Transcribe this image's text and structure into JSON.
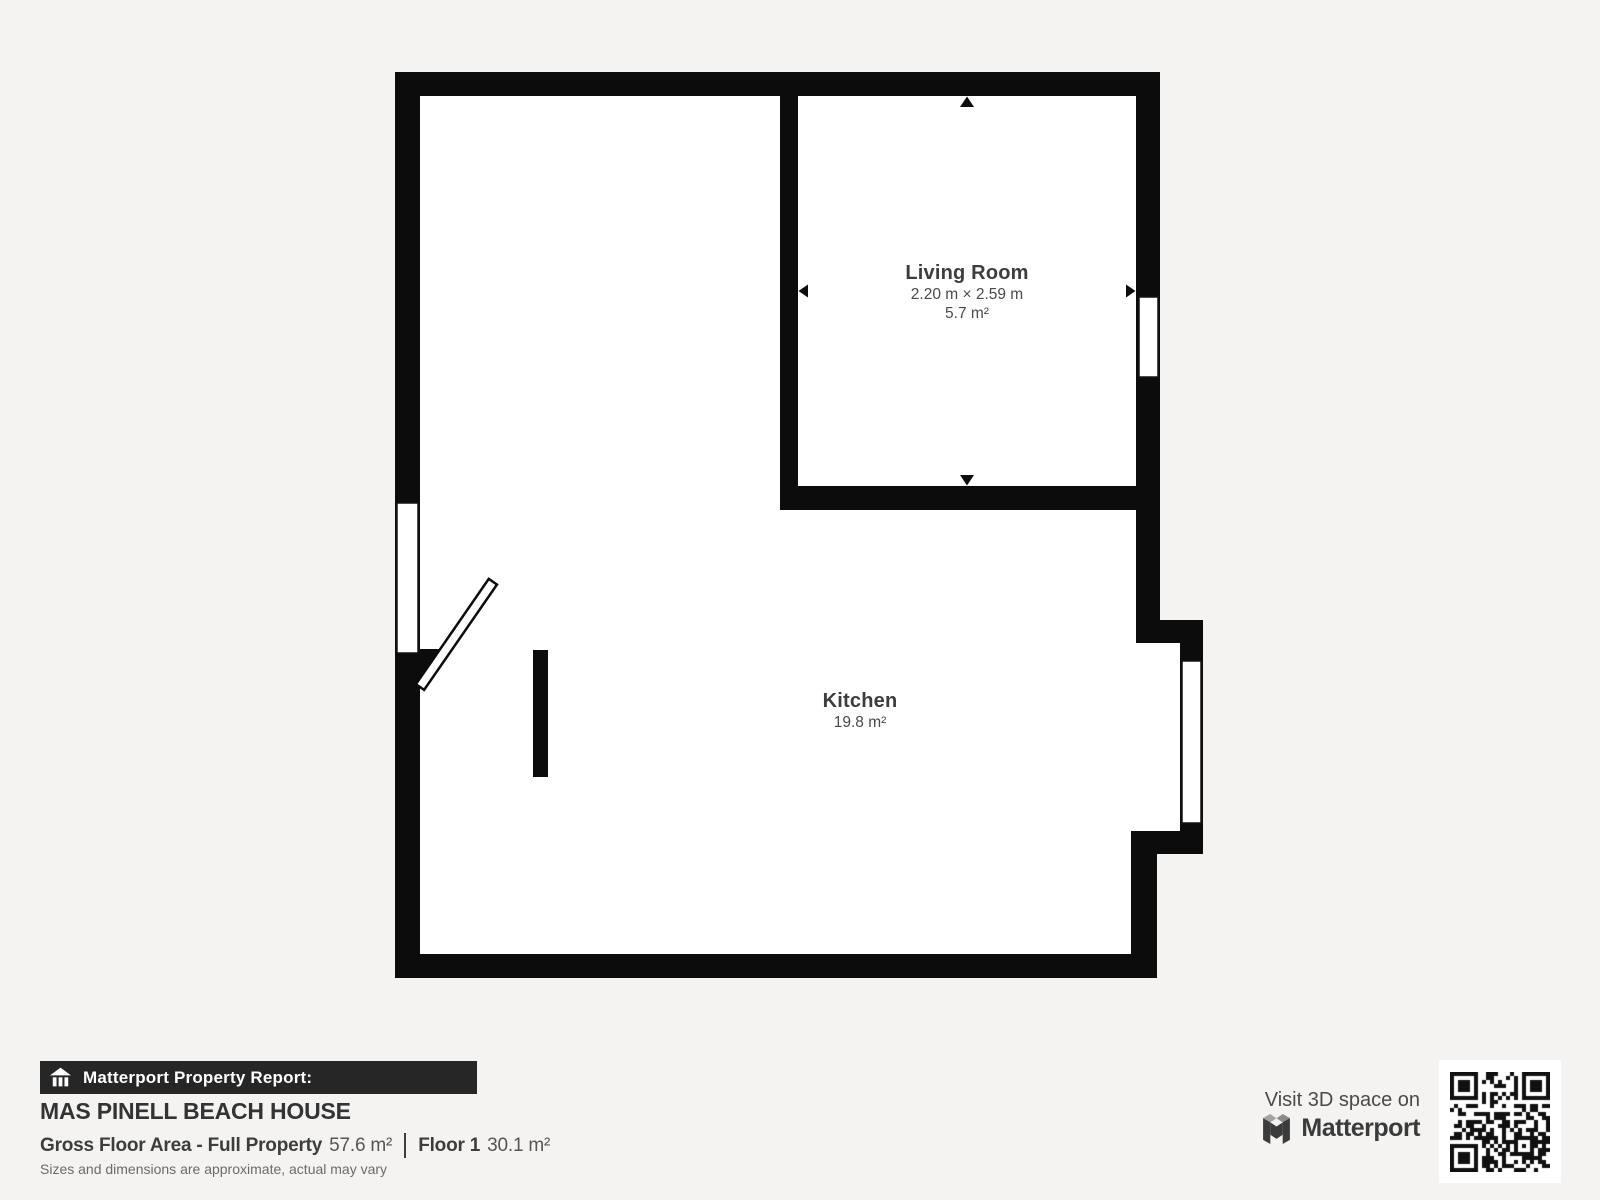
{
  "rooms": {
    "living_room": {
      "name": "Living Room",
      "dims": "2.20 m × 2.59 m",
      "area": "5.7 m²"
    },
    "kitchen": {
      "name": "Kitchen",
      "area": "19.8 m²"
    }
  },
  "footer": {
    "report_label": "Matterport Property Report:",
    "property_name": "MAS PINELL BEACH HOUSE",
    "gross_label": "Gross Floor Area - Full Property",
    "gross_value": "57.6 m²",
    "floor_label": "Floor 1",
    "floor_value": "30.1 m²",
    "disclaimer": "Sizes and dimensions are approximate, actual may vary"
  },
  "cta": {
    "visit_text": "Visit 3D space on",
    "brand": "Matterport"
  },
  "colors": {
    "background": "#f4f3f1",
    "wall": "#0c0c0c",
    "plan_floor": "#ffffff",
    "report_bar_bg": "#262626",
    "title_text": "#333333",
    "label_text": "#3d3d3d",
    "muted_text": "#6b6b6b"
  }
}
